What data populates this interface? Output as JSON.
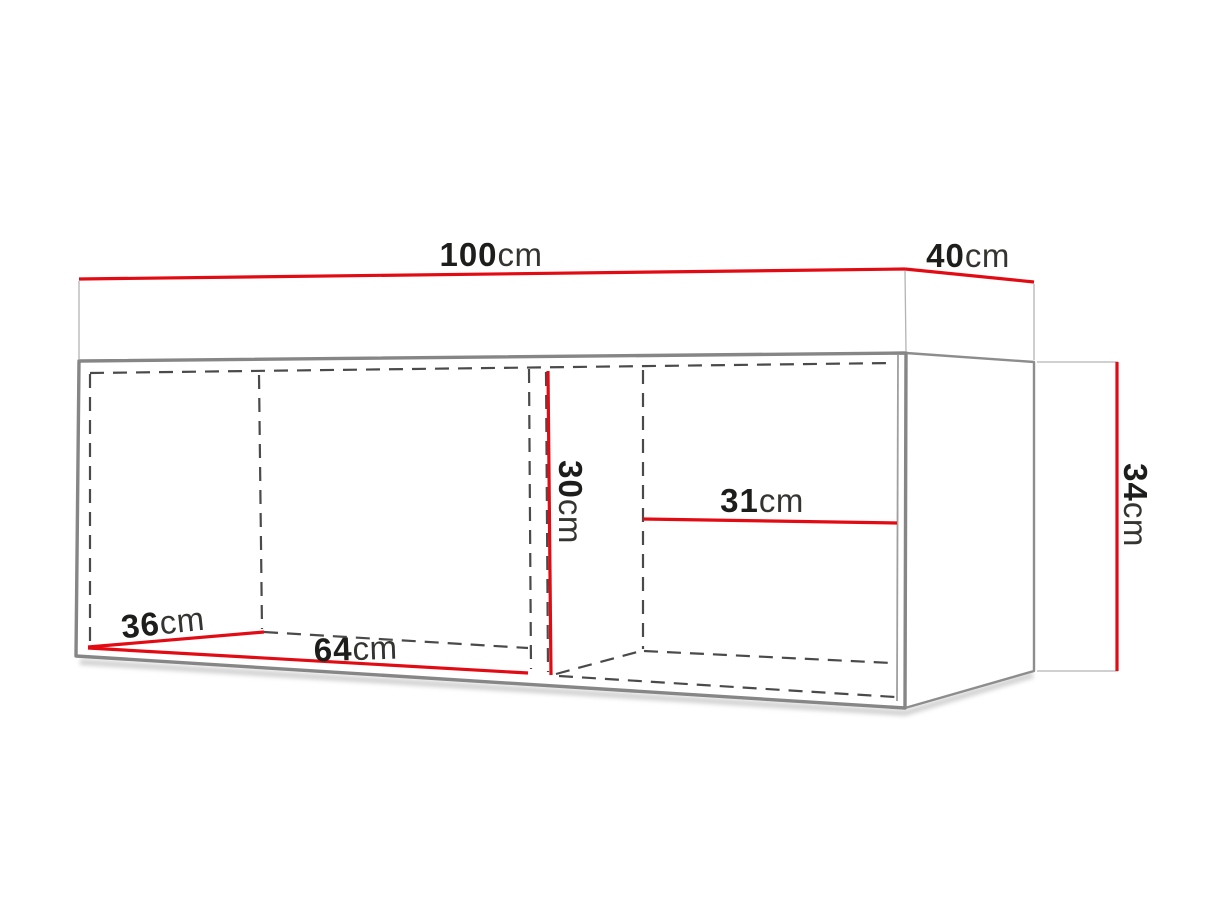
{
  "diagram": {
    "type": "furniture_dimension_diagram",
    "unit": "cm",
    "dimensions": {
      "width": {
        "value": "100",
        "unit": "cm"
      },
      "depth": {
        "value": "40",
        "unit": "cm"
      },
      "height": {
        "value": "34",
        "unit": "cm"
      },
      "interior_height": {
        "value": "30",
        "unit": "cm"
      },
      "right_compartment_width": {
        "value": "31",
        "unit": "cm"
      },
      "interior_depth": {
        "value": "36",
        "unit": "cm"
      },
      "left_compartment_width": {
        "value": "64",
        "unit": "cm"
      }
    },
    "colors": {
      "dimension_line": "#e30b13",
      "outline": "#868686",
      "hidden_line": "#4a4a4a",
      "extension_line": "#b3b3b3",
      "value_text": "#1d1d1b",
      "unit_text": "#343431",
      "background": "#ffffff"
    }
  }
}
